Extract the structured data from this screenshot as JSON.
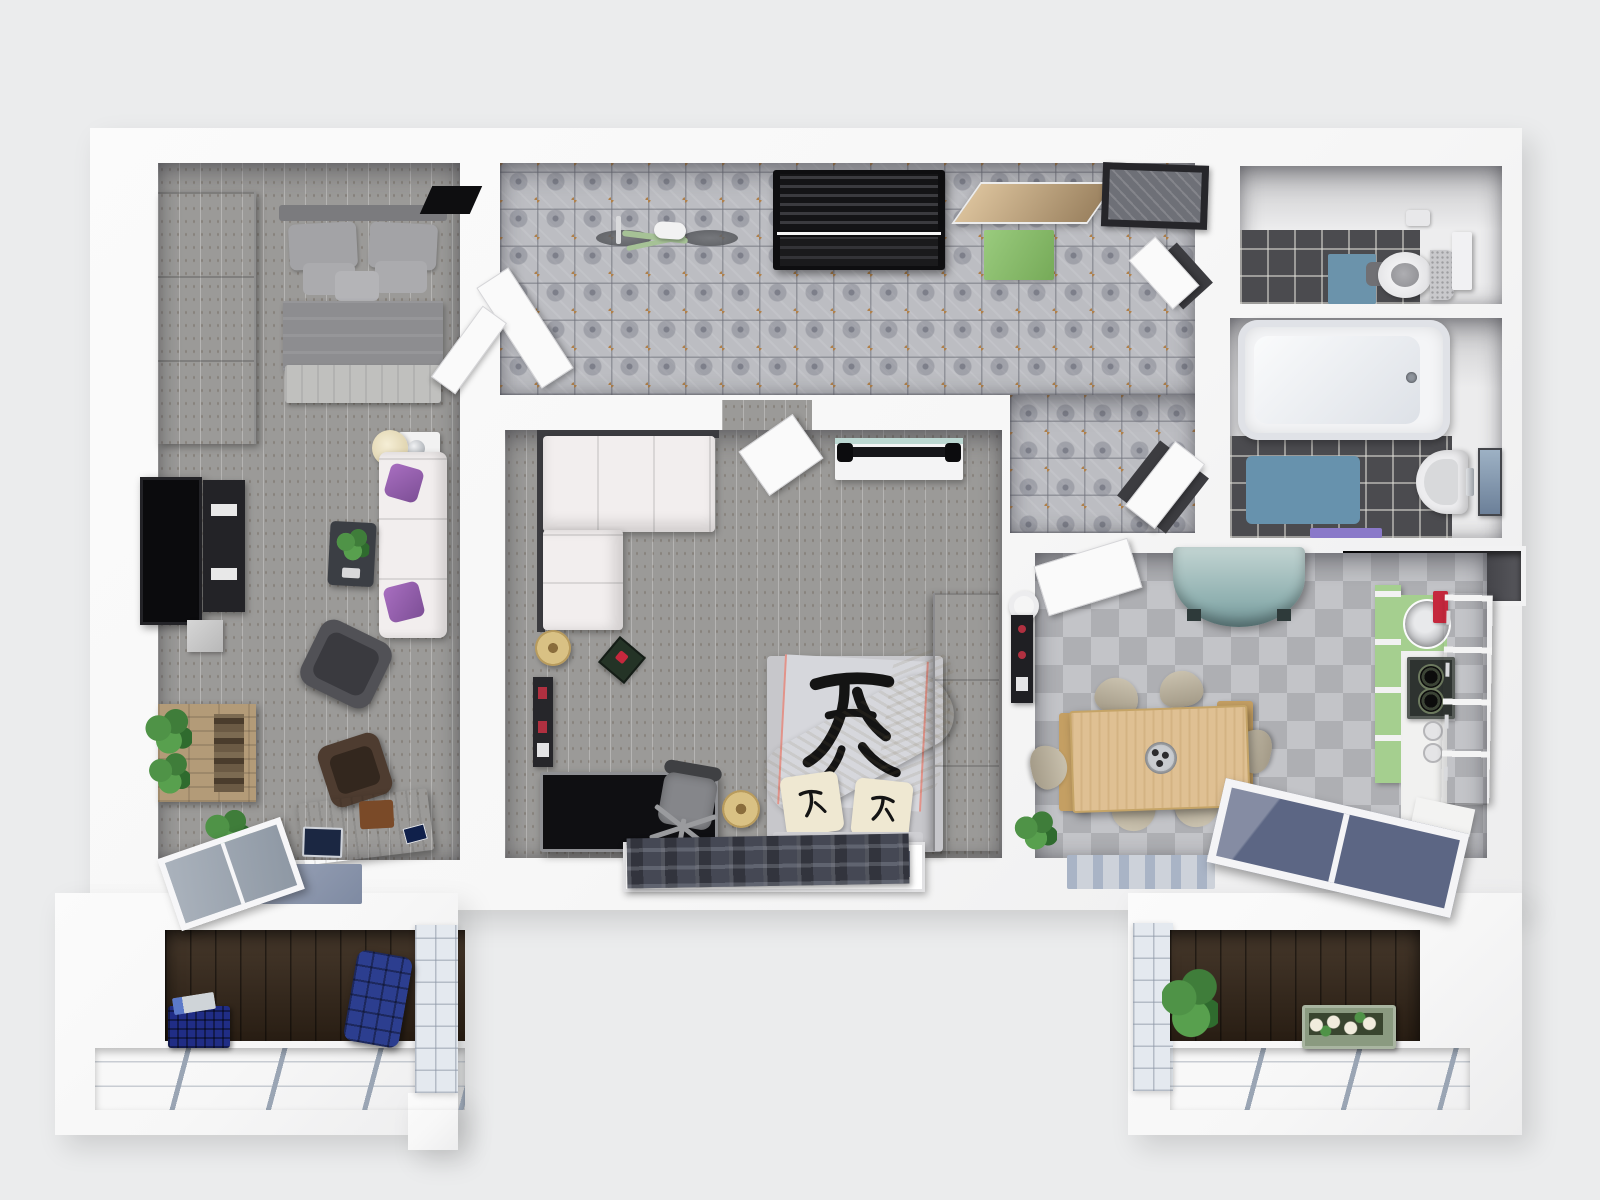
{
  "meta": {
    "title": "3D apartment floor plan — top-down render",
    "description": "Photorealistic top-down 3D render of a furnished two-bedroom apartment with hallway, WC, bathroom, kitchen-dining room and two balconies"
  },
  "palette": {
    "bg": "#ebeced",
    "wall": "#f7f7f7",
    "wallShade": "#dfdfe1",
    "plank": "#9b9a98",
    "tileBase": "#bcbdc2",
    "tileInk": "#7d7f8a",
    "tileAccent": "#b08049",
    "darkTile": "#4b4b4f",
    "checkA": "#c3c4c8",
    "checkB": "#aeafb3",
    "deck": "#38291b",
    "railGlass": "#f4f6f9",
    "railBar": "#9aa5b4",
    "doorWhite": "#fafafa",
    "sofaWhite": "#f2eeee",
    "pillowPurple": "#9b59b0",
    "wardrobeGrey": "#b7b7b7",
    "tvBlack": "#0b0b0d",
    "deskWood": "#9a6a41",
    "palletWood": "#b39b78",
    "plantGreen": "#4f9347",
    "doormatGreen": "#8cbf70",
    "bikeGreen": "#a6c296",
    "benchBlack": "#1c1c1f",
    "wcMatBlue": "#6b93ab",
    "bathMatBlue": "#6792ad",
    "towelPurple": "#8a79c9",
    "mirrorBlue": "#8aa0b5",
    "tealCab": "#8fb0b0",
    "kitchenGreen": "#a5cf8f",
    "kitchenGreenLight": "#bfe3a6",
    "counterWhite": "#f1f1f0",
    "boardRed": "#c5283d",
    "tableWood": "#dfc093",
    "chairBeige": "#bdb4a1",
    "benchTan": "#c49f63",
    "rugDark": "#454854",
    "rugBlueGrey": "#8d97ad",
    "rugKitchen": "#cdd2da",
    "rugKitchenStripe": "#a9b4c6",
    "crateBlue": "#202d86",
    "chairBlue": "#2c3e8f",
    "planterGreen": "#8a9a80",
    "flowerYellow": "#e8c832",
    "lampGold": "#d9c184",
    "bedGrey": "#c7c7cb",
    "duvetPanel": "#d6d7dc",
    "cream": "#efe7cf",
    "kanji": "#141414",
    "cabinetGrey": "#a9a9ab",
    "glassDark": "#5c6684",
    "niche": "#141416",
    "frameDark": "#26262a"
  },
  "rooms": [
    {
      "id": "bedroom",
      "label": "Bedroom",
      "floor": "grey wood planks"
    },
    {
      "id": "hallway",
      "label": "Hallway / Entry",
      "floor": "ornamental ceramic tile"
    },
    {
      "id": "living",
      "label": "Living room / Second bedroom",
      "floor": "grey wood planks"
    },
    {
      "id": "wc",
      "label": "WC",
      "floor": "dark grey tile"
    },
    {
      "id": "bathroom",
      "label": "Bathroom",
      "floor": "dark grey tile"
    },
    {
      "id": "kitchen",
      "label": "Kitchen / Dining room",
      "floor": "grey checkerboard tile"
    },
    {
      "id": "balcony_left",
      "label": "Balcony (left)",
      "floor": "dark wood decking"
    },
    {
      "id": "balcony_right",
      "label": "Balcony (right)",
      "floor": "dark wood decking"
    }
  ],
  "furniture": {
    "bedroom": [
      "Wardrobe",
      "Double bed with grey bedding",
      "Black door mat",
      "Bedside table with lamp",
      "Wall-mounted TV",
      "Media shelf",
      "Sofa with purple cushions",
      "Coffee table with plant",
      "Armchair",
      "Pallet shelf with plants",
      "Desk with laptop",
      "Desk chair",
      "Potted plant",
      "Tilted balcony window",
      "Blue-grey rug"
    ],
    "hallway": [
      "Green bicycle",
      "Black coat-rack bench",
      "Entry door",
      "Green doormat",
      "Dark framed doormat",
      "Bedroom double door",
      "Living room door",
      "WC door",
      "Bathroom door"
    ],
    "living": [
      "White corner sofa",
      "Sideboard with dumbbell bar",
      "Gold floor cushion",
      "Serving tray",
      "Wall shelf",
      "Black desk",
      "Office chair",
      "Gold floor cushion",
      "Double bed with kanji bedding",
      "Tall grey cabinet",
      "Plaid rug",
      "Floor-level window"
    ],
    "wc": [
      "Toilet with open lid",
      "Cistern",
      "Blue mat",
      "Toilet paper holder"
    ],
    "bathroom": [
      "Bathtub",
      "Blue bath mat",
      "Washbasin",
      "Mirror",
      "Purple towel"
    ],
    "kitchen": [
      "Kitchen door",
      "Teal corner cabinet",
      "Paper-roll holder",
      "Wine rack",
      "Dining table with trivet",
      "Six beige chairs",
      "Wooden bench",
      "Round sink",
      "Red cutting board",
      "Two-burner cooktop",
      "Green cabinet columns",
      "Potted plant",
      "Vase with yellow flowers",
      "Tilted window",
      "Striped rug"
    ],
    "balcony_left": [
      "Blue storage crate",
      "Magazine",
      "Blue quilted armchair",
      "Glass railing",
      "Side glass panel"
    ],
    "balcony_right": [
      "Potted plant",
      "Flower planter box",
      "Glass railing",
      "Side glass panel"
    ],
    "dark_niche": [
      "Black countertop niche"
    ]
  }
}
